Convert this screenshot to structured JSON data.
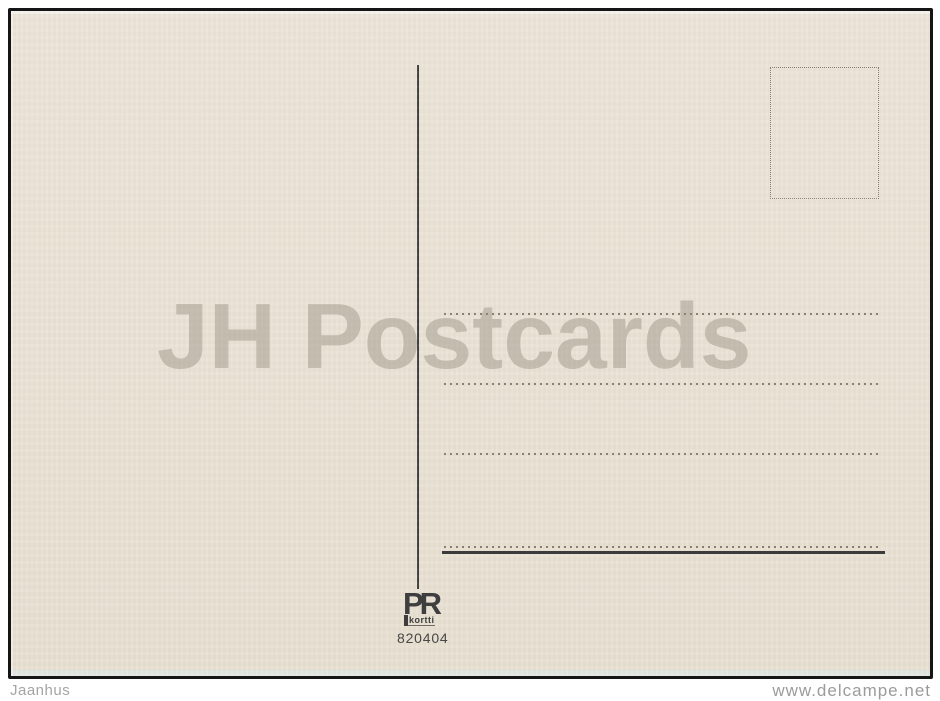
{
  "postcard": {
    "watermark_text": "JH Postcards",
    "publisher": {
      "initials": "PR",
      "name": "kortti"
    },
    "card_number": "820404",
    "address_line_count": 3,
    "stamp_box": "empty dotted stamp placeholder"
  },
  "footer": {
    "seller": "Jaanhus",
    "site": "www.delcampe.net"
  },
  "colors": {
    "paper": "#eae3d6",
    "ink": "#3c3c3c",
    "dots": "#8a8072",
    "watermark": "#cbc6ba",
    "frame": "#151515",
    "footer_text": "#9e9e9e"
  }
}
